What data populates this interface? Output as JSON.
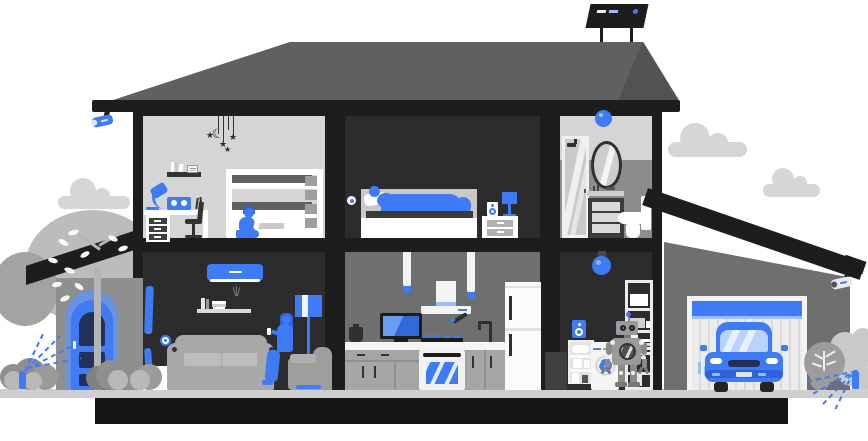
{
  "title": "Smart home cutaway illustration",
  "glyphs": {
    "star": "★",
    "moon": "☾"
  },
  "palette": {
    "blue": "#3e7bf5",
    "blueDark": "#2e62d6",
    "blueNavy": "#22305a",
    "blueSky": "#b9d3fb",
    "blueSoft": "#9dbcf7",
    "archBlue": "#6b92dd",
    "ink": "#1d1d1d",
    "roomDark": "#2c2c2e",
    "roof": "#606062",
    "roofShade": "#525254",
    "wallMid": "#6f6f6f",
    "bathLower": "#8d8d8d",
    "roomLight": "#d5d5d5",
    "ground": "#cfcfcf",
    "foundation": "#151515",
    "cloud": "#d6d6d6",
    "porch": "#8f8f8f",
    "garage": "#6f6f6f",
    "white": "#ffffff",
    "offWhite": "#f2f2f2",
    "grayLight": "#c9c9c9",
    "sofa": "#a8a8a8",
    "treeLight": "#bcbcbc",
    "treeMid": "#a3a3a3",
    "bush": "#8f8f8f",
    "bushLight": "#b8b8b8",
    "metal": "#333333",
    "mattress": "#5f5f5f"
  },
  "scene": {
    "exterior": {
      "items": [
        "cloud-left",
        "cloud-right-large",
        "cloud-right-small",
        "solar-panel",
        "security-camera-left",
        "security-camera-right",
        "porch-roof",
        "front-door",
        "tree-round-left",
        "tree-branch",
        "bushes",
        "sprinkler-left",
        "sprinkler-right",
        "garage-roof",
        "garage-door",
        "car",
        "round-bush",
        "ground",
        "foundation"
      ]
    },
    "rooms": [
      {
        "name": "kids-room",
        "items": [
          "hanging-mobile",
          "wall-shelf-books",
          "desk-lamp",
          "smart-speaker",
          "desk",
          "drawer-unit",
          "desk-chair",
          "bunk-bed",
          "child-with-tablet"
        ]
      },
      {
        "name": "bedroom",
        "items": [
          "smart-sensor",
          "bed",
          "sleeping-person",
          "pillow",
          "nightstand",
          "speaker",
          "table-lamp"
        ]
      },
      {
        "name": "bathroom",
        "items": [
          "smart-ceiling-light",
          "shower-cabin",
          "mirror",
          "vanity-cabinet",
          "toilet"
        ]
      },
      {
        "name": "living-room",
        "items": [
          "air-conditioner",
          "wall-shelf",
          "smart-sensor",
          "curtains",
          "side-table",
          "sofa",
          "woman-with-phone",
          "armchair",
          "floor-lamp"
        ]
      },
      {
        "name": "kitchen",
        "items": [
          "pendant-lamp-1",
          "pendant-lamp-2",
          "range-hood",
          "tv",
          "kettle",
          "counter",
          "gas-burners",
          "oven",
          "cabinets",
          "faucet",
          "fridge"
        ]
      },
      {
        "name": "utility-room",
        "items": [
          "smart-bulb",
          "smart-speaker",
          "storage-shelf",
          "washing-machine",
          "robot-assistant",
          "storage-rack",
          "trash-bin"
        ]
      }
    ]
  }
}
